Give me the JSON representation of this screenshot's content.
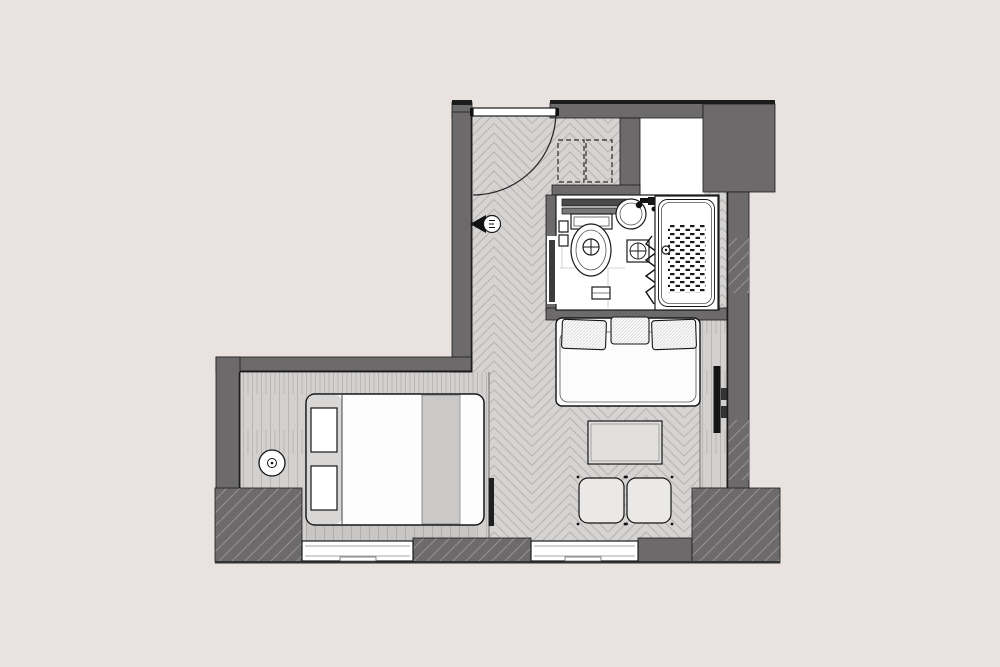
{
  "title": "studio-apartment-floor-plan",
  "colors": {
    "background": "#EAE2E0",
    "wall": "#6D6A6B",
    "wall_dark": "#1C1C1C",
    "line": "#1A1A1A",
    "floor": "#D6D4D3",
    "floor_line": "#B7B4B3",
    "plank": "#D3D1D0",
    "plank_line": "#B9B6B5",
    "hatch_line": "#969293",
    "white": "#FFFFFF",
    "headband": "#D9D7D6",
    "blanket": "#CBC9C8",
    "table": "#E2E0DF",
    "pouf": "#EBE9E8",
    "tv": "#141414"
  },
  "plan": {
    "floors": [
      {
        "name": "main-room-floor",
        "pattern": "herringbone"
      },
      {
        "name": "bedroom-floor",
        "pattern": "wood-planks"
      },
      {
        "name": "bathroom-floor",
        "pattern": "plain-white"
      },
      {
        "name": "console-strip",
        "pattern": "wood-planks"
      }
    ],
    "entry": {
      "door": "single-swing-door",
      "door_swing": "quarter-arc",
      "peephole_symbol": true,
      "wardrobe": {
        "type": "dashed-outline",
        "sections": 2
      }
    },
    "bathroom": {
      "fixtures": [
        "shelf",
        "toilet",
        "washbasin",
        "tap",
        "mixer-box",
        "shower-curtain",
        "bathtub",
        "floor-drain",
        "anti-slip-mat"
      ]
    },
    "furniture": {
      "daybed": {
        "pillows": 3
      },
      "coffee_table": 1,
      "ottomans": 2,
      "double_bed": {
        "pillows": 2,
        "blanket_strip": true
      },
      "side_table": 1,
      "tv": {
        "mounted_on": "right-wall"
      }
    },
    "windows": 2
  }
}
